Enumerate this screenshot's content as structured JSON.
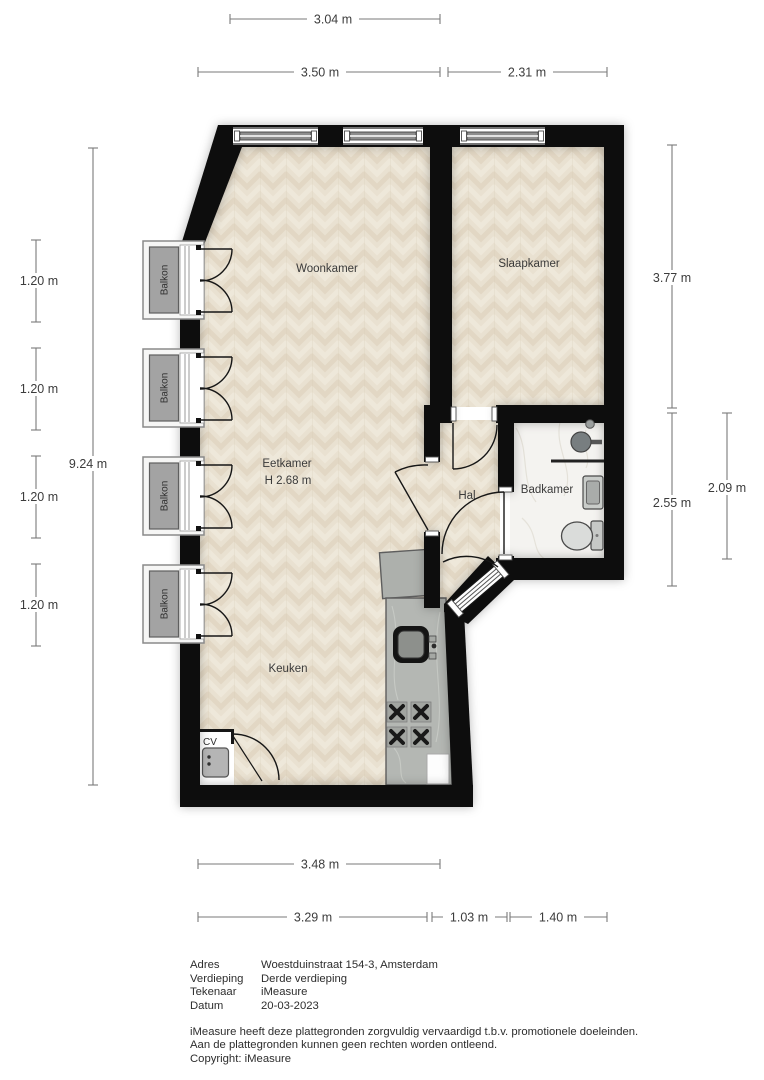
{
  "rooms": {
    "woonkamer": "Woonkamer",
    "slaapkamer": "Slaapkamer",
    "eetkamer": "Eetkamer",
    "eetkamer_ceiling": "H 2.68 m",
    "hal": "Hal",
    "badkamer": "Badkamer",
    "keuken": "Keuken",
    "cv": "CV",
    "balkon": "Balkon"
  },
  "dimensions": {
    "top_windows": "3.04 m",
    "top_left": "3.50 m",
    "top_right": "2.31 m",
    "left_balkon": [
      "1.20 m",
      "1.20 m",
      "1.20 m",
      "1.20 m"
    ],
    "left_total": "9.24 m",
    "right_upper": "3.77 m",
    "right_lower": "2.55 m",
    "right_inner": "2.09 m",
    "bottom_upper": "3.48 m",
    "bottom_left": "3.29 m",
    "bottom_mid": "1.03 m",
    "bottom_right": "1.40 m"
  },
  "info": {
    "rows": [
      {
        "label": "Adres",
        "value": "Woestduinstraat 154-3, Amsterdam"
      },
      {
        "label": "Verdieping",
        "value": "Derde verdieping"
      },
      {
        "label": "Tekenaar",
        "value": "iMeasure"
      },
      {
        "label": "Datum",
        "value": "20-03-2023"
      }
    ],
    "disclaimer": [
      "iMeasure heeft deze plattegronden zorgvuldig vervaardigd t.b.v. promotionele doeleinden.",
      "Aan de plattegronden kunnen geen rechten worden ontleend.",
      "Copyright: iMeasure"
    ]
  },
  "colors": {
    "wall": "#0d0d0d",
    "wood_floor": "#e9e1d1",
    "marble_floor": "#f4f3f0",
    "balcony_gray": "#a3a3a3",
    "counter_gray": "#b4b7b3",
    "dimension_line": "#7a7a7a",
    "text": "#3c3c3c"
  }
}
